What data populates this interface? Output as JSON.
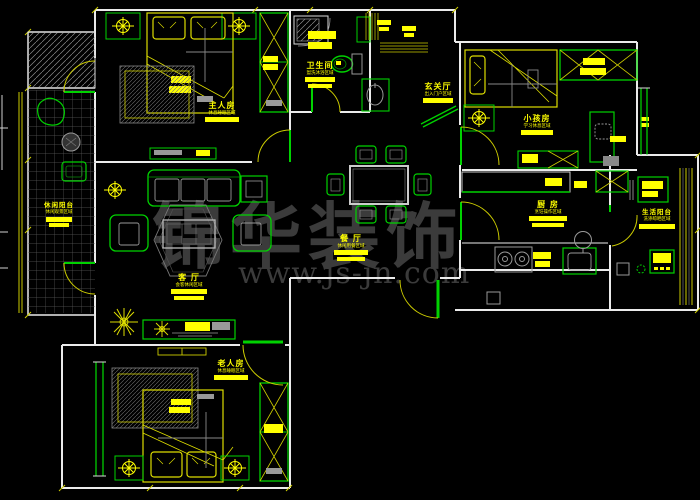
{
  "watermark": {
    "brand": "锦华装饰",
    "url": "www.js-jn.com"
  },
  "colors": {
    "background": "#000000",
    "walls": "#ebebeb",
    "fixtures": "#00d200",
    "annotations": "#ffff00",
    "details": "#9a9a9a",
    "watermark": "#3b3b3b"
  },
  "rooms": [
    {
      "id": "master-bedroom",
      "name": "主人房",
      "desc": "休息睡眠区域"
    },
    {
      "id": "bathroom",
      "name": "卫生间",
      "desc": "盥洗沐浴区域"
    },
    {
      "id": "entry-hall",
      "name": "玄关厅",
      "desc": "出入门户区域"
    },
    {
      "id": "kids-room",
      "name": "小孩房",
      "desc": "学习休息区域"
    },
    {
      "id": "kitchen",
      "name": "厨 房",
      "desc": "烹饪操作区域"
    },
    {
      "id": "service-balcony",
      "name": "生活阳台",
      "desc": "洗涤晾晒区域"
    },
    {
      "id": "dining-room",
      "name": "餐 厅",
      "desc": "休闲用餐区域"
    },
    {
      "id": "living-room",
      "name": "客 厅",
      "desc": "会客休闲区域"
    },
    {
      "id": "leisure-balcony",
      "name": "休闲阳台",
      "desc": "休闲观景区域"
    },
    {
      "id": "elder-room",
      "name": "老人房",
      "desc": "休息睡眠区域"
    }
  ]
}
